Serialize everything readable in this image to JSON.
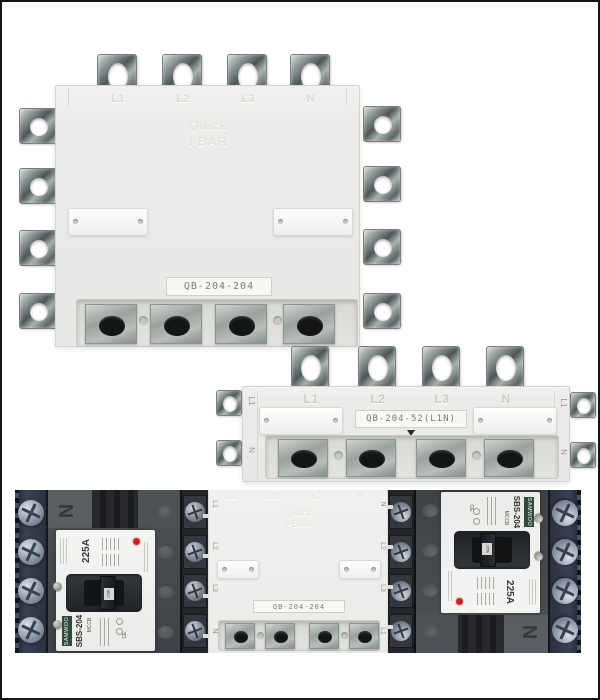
{
  "top_view": {
    "model": "QB-204-204",
    "emboss": [
      "Quick",
      "I-BAR"
    ],
    "face_labels": [
      "L1",
      "L2",
      "L3",
      "N"
    ],
    "left_labels": [
      "L1",
      "L2",
      "L3",
      "N"
    ],
    "right_labels": [
      "N",
      "L2",
      "L3",
      "L1"
    ]
  },
  "strip_view": {
    "model": "QB-204-52(L1N)",
    "face_labels": [
      "L1",
      "L2",
      "L3",
      "N"
    ],
    "left_labels": [
      "L1",
      "N"
    ],
    "right_labels": [
      "L1",
      "N"
    ]
  },
  "assembly_view": {
    "busbar": {
      "model": "QB-204-204",
      "emboss": [
        "Quick",
        "I-BAR"
      ],
      "face_labels": [
        "L1",
        "L2",
        "L3",
        "N"
      ],
      "left_labels": [
        "L1",
        "L2",
        "L3",
        "N"
      ],
      "right_labels": [
        "N",
        "L2",
        "L3",
        "L1"
      ]
    },
    "breaker": {
      "brand": "SAMWOO",
      "type": "MCCB",
      "model": "SBS-204",
      "rating": "225A",
      "handle_label": "225A",
      "pole_mark": "N",
      "cert": "CE"
    }
  },
  "colors": {
    "page_border": "#151515",
    "unit_body": "#ebebe9",
    "metal_terminal": "#8f9897",
    "navy_terminal_block": "#2b3140",
    "breaker_body_gray": "#46494e",
    "breaker_panel_white": "#f2f2f0",
    "indicator_red": "#c9262a"
  }
}
